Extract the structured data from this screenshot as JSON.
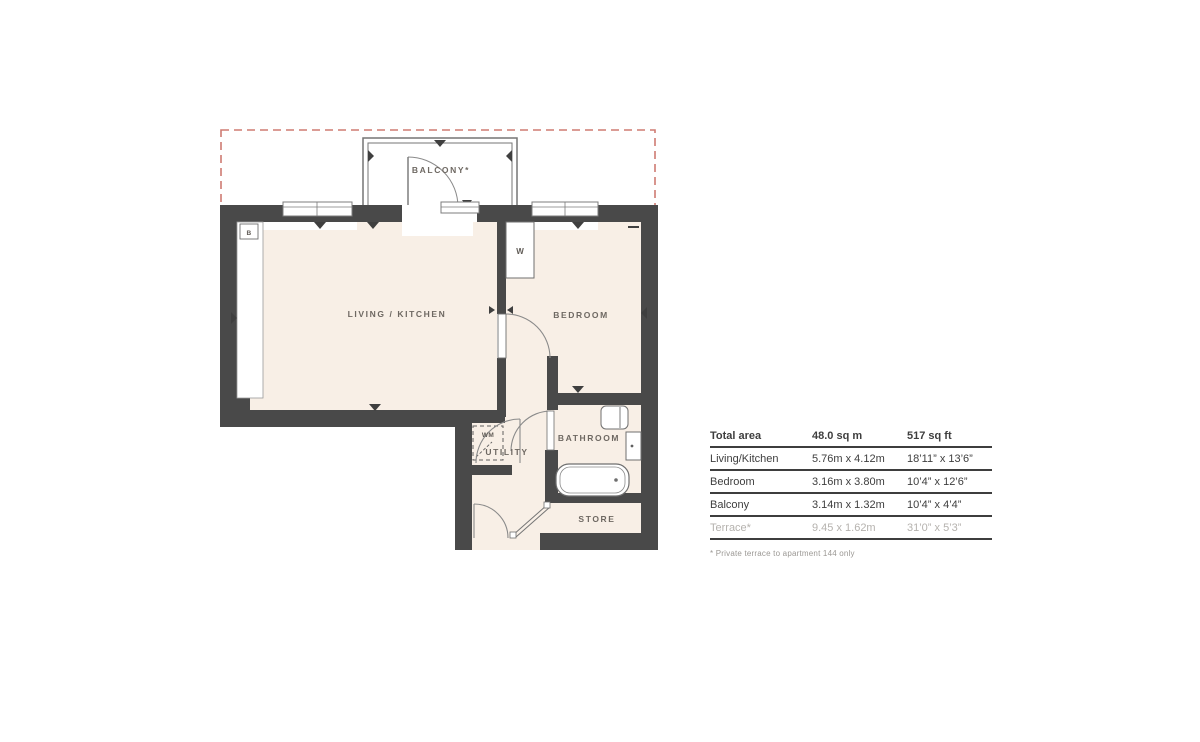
{
  "floorplan": {
    "rooms": {
      "living_kitchen": "LIVING / KITCHEN",
      "bedroom": "BEDROOM",
      "bathroom": "BATHROOM",
      "utility": "UTILITY",
      "store": "STORE",
      "balcony": "BALCONY*",
      "wardrobe": "W",
      "washing_machine": "WM",
      "boiler": "B"
    },
    "colors": {
      "wall": "#494949",
      "floor_fill": "#f8efe6",
      "terrace_dashed_outline": "#cf7b72",
      "fixture_outline": "#6f6f6f"
    }
  },
  "table": {
    "header": {
      "label": "Total area",
      "metric": "48.0 sq m",
      "imperial": "517 sq ft"
    },
    "rows": [
      {
        "label": "Living/Kitchen",
        "metric": "5.76m x 4.12m",
        "imperial": "18’11” x 13’6”"
      },
      {
        "label": "Bedroom",
        "metric": "3.16m x 3.80m",
        "imperial": "10’4” x 12’6”"
      },
      {
        "label": "Balcony",
        "metric": "3.14m x 1.32m",
        "imperial": "10’4” x 4’4”"
      },
      {
        "label": "Terrace*",
        "metric": "9.45 x 1.62m",
        "imperial": "31’0” x 5’3”"
      }
    ],
    "footnote": "* Private terrace to apartment 144 only"
  }
}
